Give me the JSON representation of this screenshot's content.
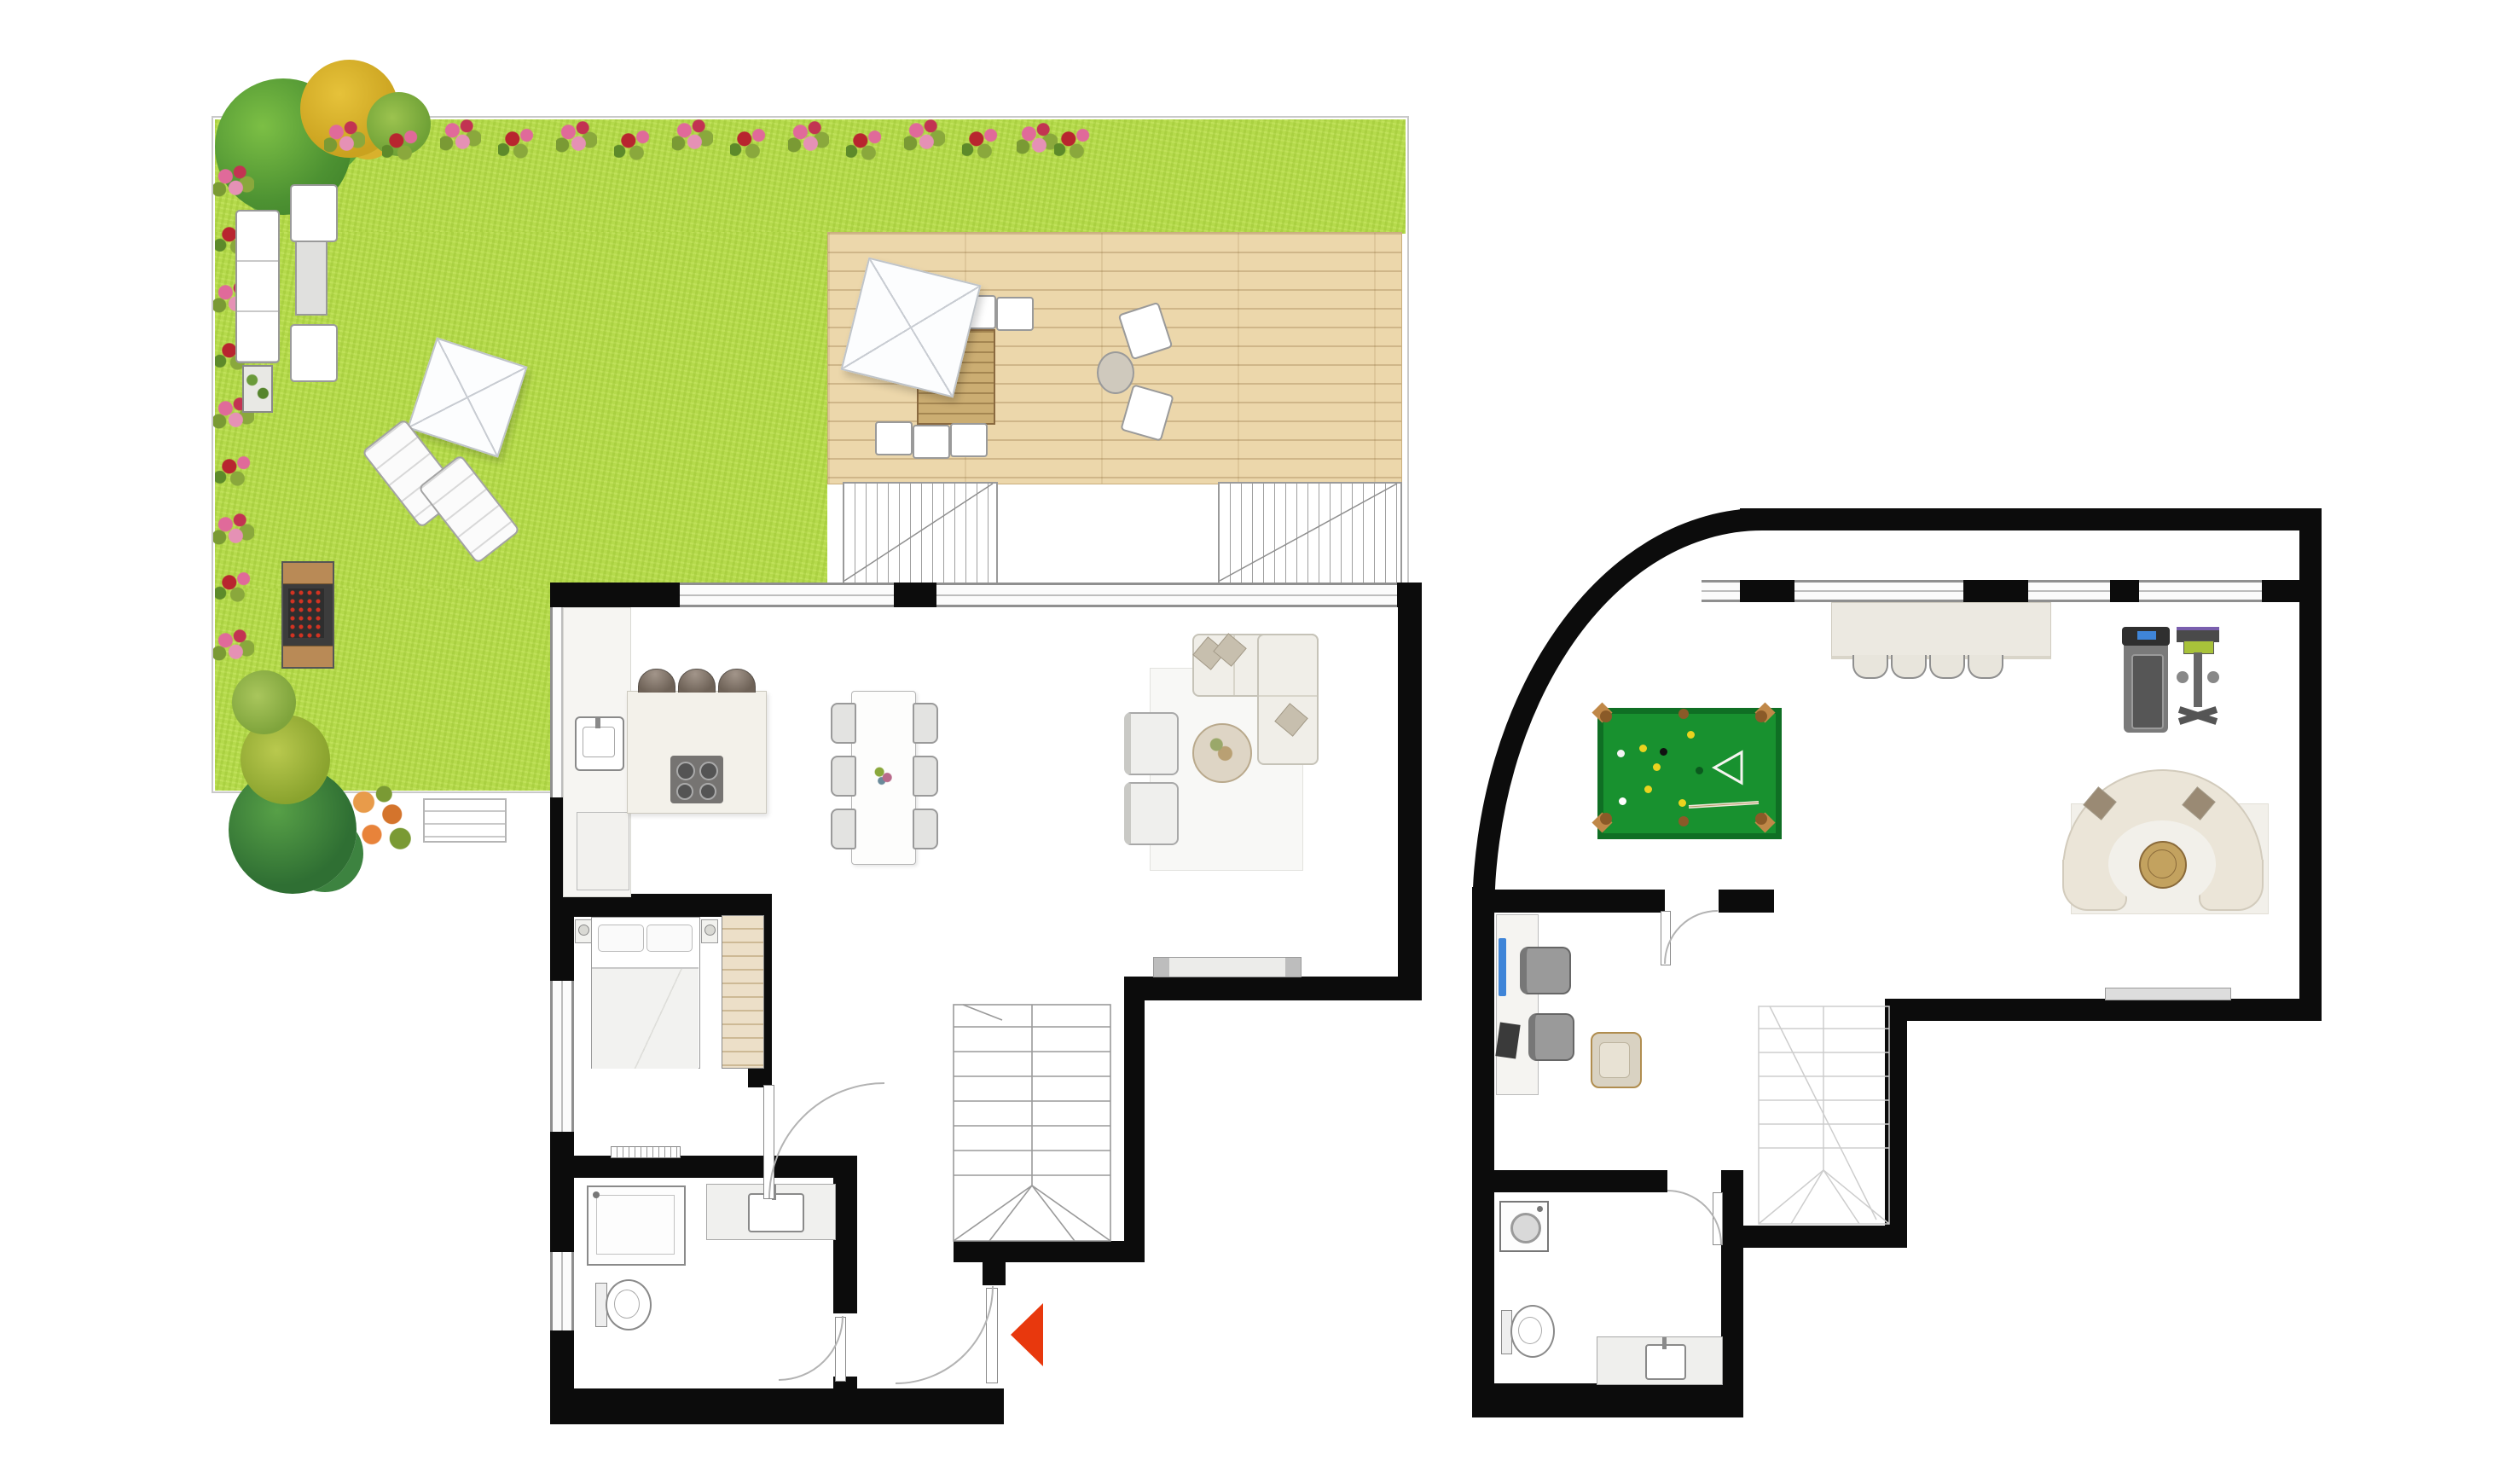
{
  "document": {
    "type": "floor-plan",
    "title": "Two-level maisonette floor plan: upper level with garden terrace, lower level with games room",
    "levels_count": 2,
    "visible_text": []
  },
  "palette": {
    "wall": "#0c0c0c",
    "lawn_green": "#b5da4c",
    "deck_wood": "#ecd7ab",
    "pool_felt_green": "#18912f",
    "pool_rail_green": "#0f6f24",
    "pocket_brown": "#8a5a28",
    "entrance_arrow_red": "#e8380d",
    "monitor_blue": "#3f85d8",
    "furniture_cream": "#f0eee8",
    "outline_gray": "#9a9a9a"
  },
  "upper_level": {
    "garden": {
      "areas": [
        "lawn",
        "wooden-deck-terrace",
        "flower-border-top",
        "flower-border-left"
      ],
      "plants": [
        "green-tree",
        "yellow-shrub",
        "small-green-shrub",
        "dark-green-tree",
        "yellow-green-bush",
        "orange-flower-bush",
        "light-green-bush"
      ],
      "furniture": [
        "outdoor-sofa",
        "outdoor-armchair",
        "outdoor-armchair",
        "outdoor-coffee-table",
        "planter-box",
        "bbq-grill",
        "sun-lounger",
        "sun-lounger",
        "garden-parasol",
        "deck-parasol",
        "deck-dining-table",
        "deck-dining-chairs-x6",
        "deck-lounge-chair",
        "deck-lounge-chair",
        "deck-side-table",
        "garden-bench",
        "terrace-skylight-grate",
        "terrace-skylight-grate"
      ]
    },
    "rooms": [
      {
        "name": "kitchen-dining-living",
        "furniture": [
          "kitchen-counter",
          "kitchen-sink",
          "base-cabinet",
          "kitchen-island",
          "cooktop-4-burners",
          "bar-stool-x3",
          "dining-table",
          "dining-chair-x6",
          "l-shaped-sofa",
          "throw-pillows-x3",
          "armchair-x2",
          "round-side-table",
          "area-rug",
          "tv-console"
        ]
      },
      {
        "name": "bedroom",
        "furniture": [
          "double-bed",
          "pillows-x2",
          "nightstand-x2",
          "wardrobe-shelved",
          "radiator"
        ],
        "windows": 1
      },
      {
        "name": "bathroom",
        "furniture": [
          "shower",
          "vanity-sink",
          "toilet"
        ],
        "windows": 1
      },
      {
        "name": "staircase",
        "type": "two-flight-with-winders"
      },
      {
        "name": "hallway",
        "features": [
          "entrance-door",
          "entrance-arrow-red",
          "bathroom-door",
          "bedroom-door"
        ]
      }
    ],
    "windows_top_wall": 2
  },
  "lower_level": {
    "rooms": [
      {
        "name": "games-room",
        "features": [
          "curved-top-left-wall"
        ],
        "furniture": [
          "billiard-table",
          "billiard-balls",
          "billiard-triangle-rack",
          "billiard-cue",
          "bar-counter",
          "bar-stool-x4",
          "treadmill",
          "exercise-machine",
          "semicircular-sofa",
          "round-coffee-table",
          "area-rug",
          "tv-console"
        ]
      },
      {
        "name": "office",
        "furniture": [
          "desk",
          "monitor-blue",
          "monitor-dark",
          "office-chair-x2",
          "lounge-armchair"
        ]
      },
      {
        "name": "bathroom",
        "furniture": [
          "washing-machine",
          "toilet",
          "vanity-sink"
        ]
      },
      {
        "name": "staircase",
        "type": "two-flight-with-winders-faint"
      }
    ],
    "windows_top_wall": 4
  }
}
